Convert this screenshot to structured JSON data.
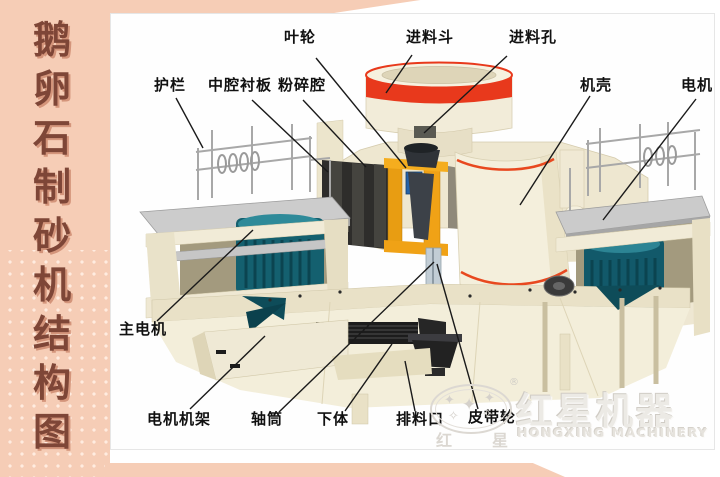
{
  "sidebar": {
    "title": "鹅卵石制砂机结构图",
    "chars": [
      "鹅",
      "卵",
      "石",
      "制",
      "砂",
      "机",
      "结",
      "构",
      "图"
    ]
  },
  "diagram": {
    "parts": [
      {
        "id": "impeller",
        "name": "叶轮"
      },
      {
        "id": "feed-hopper",
        "name": "进料斗"
      },
      {
        "id": "feed-port",
        "name": "进料孔"
      },
      {
        "id": "guardrail",
        "name": "护栏"
      },
      {
        "id": "middle-chamber-liner",
        "name": "中腔衬板"
      },
      {
        "id": "crushing-chamber",
        "name": "粉碎腔"
      },
      {
        "id": "casing",
        "name": "机壳"
      },
      {
        "id": "motor",
        "name": "电机"
      },
      {
        "id": "main-motor",
        "name": "主电机"
      },
      {
        "id": "motor-frame",
        "name": "电机机架"
      },
      {
        "id": "shaft-cylinder",
        "name": "轴筒"
      },
      {
        "id": "lower-body",
        "name": "下体"
      },
      {
        "id": "discharge-port",
        "name": "排料口"
      },
      {
        "id": "belt-pulley",
        "name": "皮带轮"
      }
    ]
  },
  "watermark": {
    "registered_mark": "®",
    "seal_char_left": "红",
    "seal_char_right": "星",
    "brand_cn": "红星机器",
    "brand_en": "HONGXING MACHINERY"
  },
  "colors": {
    "sidebar_bg": "#f6cdb6",
    "sidebar_text": "#7e4637",
    "label_text": "#111111",
    "machine_cream": "#f2ecd8",
    "machine_teal": "#14606f",
    "machine_orange": "#f0a216",
    "accent_red": "#e8391c",
    "watermark_gray": "#dcd8d2"
  }
}
